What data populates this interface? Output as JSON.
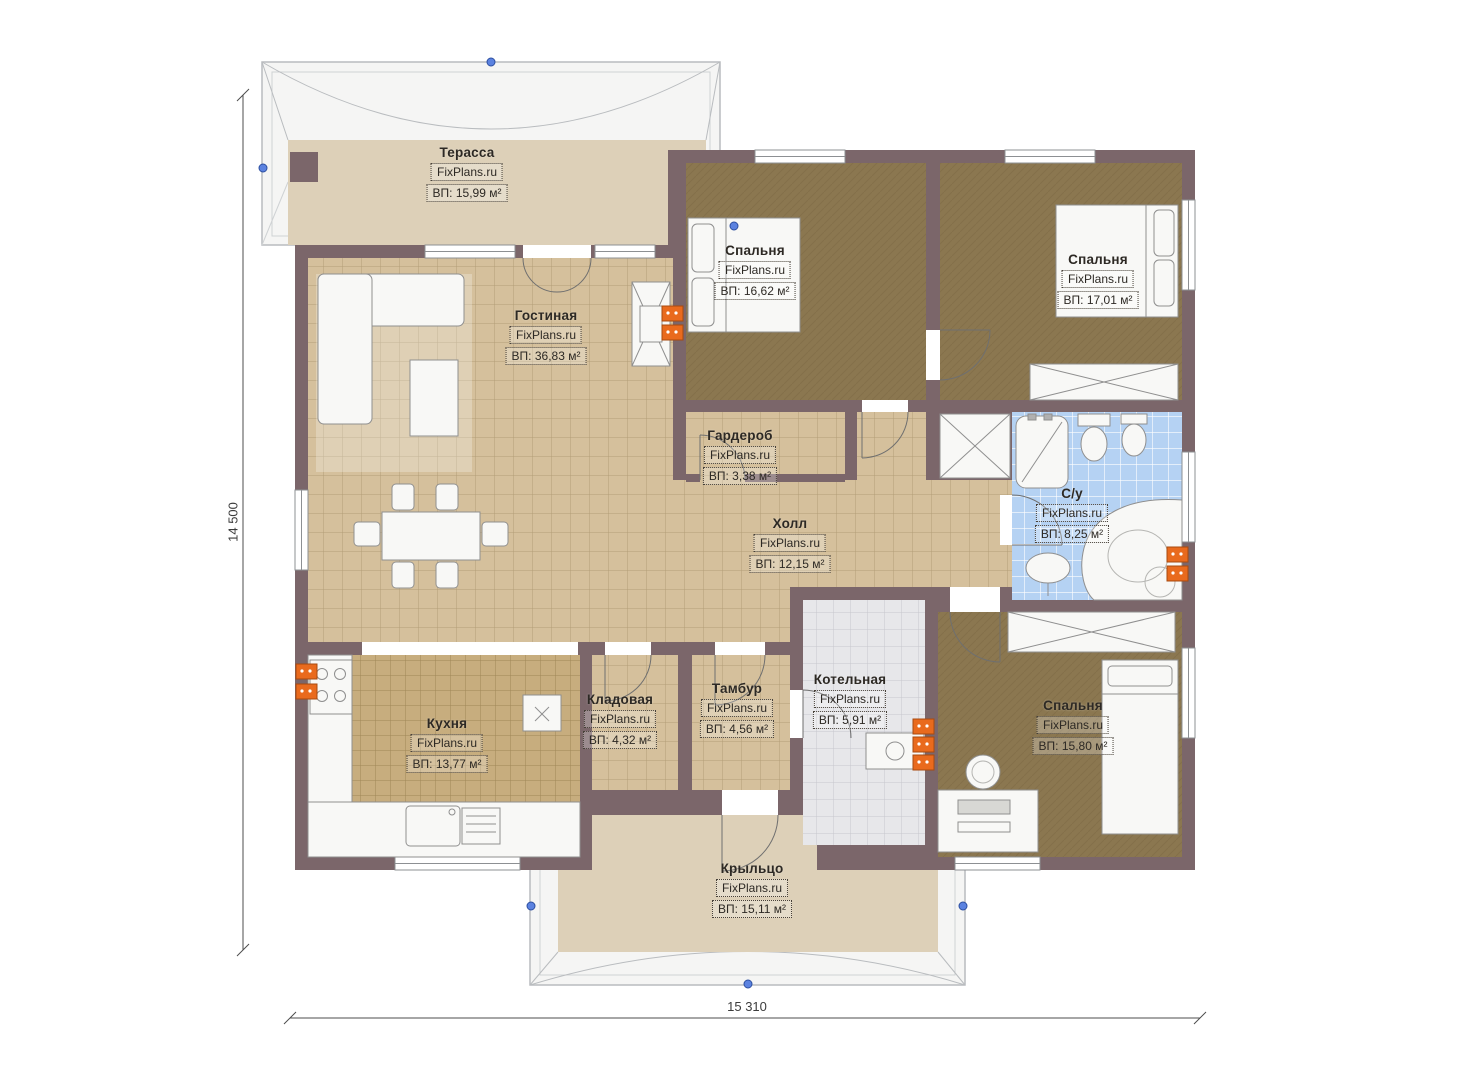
{
  "brand": "FixPlans.ru",
  "dimensions": {
    "left": "14 500",
    "bottom": "15 310"
  },
  "rooms": [
    {
      "id": "terrace",
      "name": "Терасса",
      "brand": "FixPlans.ru",
      "area": "ВП: 15,99 м²"
    },
    {
      "id": "living",
      "name": "Гостиная",
      "brand": "FixPlans.ru",
      "area": "ВП: 36,83 м²"
    },
    {
      "id": "bedroom-1",
      "name": "Спальня",
      "brand": "FixPlans.ru",
      "area": "ВП: 16,62 м²"
    },
    {
      "id": "bedroom-2",
      "name": "Спальня",
      "brand": "FixPlans.ru",
      "area": "ВП: 17,01 м²"
    },
    {
      "id": "wardrobe",
      "name": "Гардероб",
      "brand": "FixPlans.ru",
      "area": "ВП: 3,38 м²"
    },
    {
      "id": "hall",
      "name": "Холл",
      "brand": "FixPlans.ru",
      "area": "ВП: 12,15 м²"
    },
    {
      "id": "bathroom",
      "name": "С/у",
      "brand": "FixPlans.ru",
      "area": "ВП: 8,25 м²"
    },
    {
      "id": "kitchen",
      "name": "Кухня",
      "brand": "FixPlans.ru",
      "area": "ВП: 13,77 м²"
    },
    {
      "id": "pantry",
      "name": "Кладовая",
      "brand": "FixPlans.ru",
      "area": "ВП: 4,32 м²"
    },
    {
      "id": "vestibule",
      "name": "Тамбур",
      "brand": "FixPlans.ru",
      "area": "ВП: 4,56 м²"
    },
    {
      "id": "boiler",
      "name": "Котельная",
      "brand": "FixPlans.ru",
      "area": "ВП: 5,91 м²"
    },
    {
      "id": "bedroom-3",
      "name": "Спальня",
      "brand": "FixPlans.ru",
      "area": "ВП: 15,80 м²"
    },
    {
      "id": "porch",
      "name": "Крыльцо",
      "brand": "FixPlans.ru",
      "area": "ВП: 15,11 м²"
    }
  ],
  "colors": {
    "wall": "#7b666a",
    "tile_beige": "#d5c09c",
    "tile_kitchen": "#c7ad7e",
    "carpet_brown": "#8b7750",
    "tile_blue": "#b5d2f3",
    "tile_gray": "#e7e7ea",
    "terrace_floor": "#ddd0b8",
    "roof_gray": "#f5f5f4",
    "accent_orange": "#e96a1d",
    "grip_blue": "#5b82e0"
  }
}
